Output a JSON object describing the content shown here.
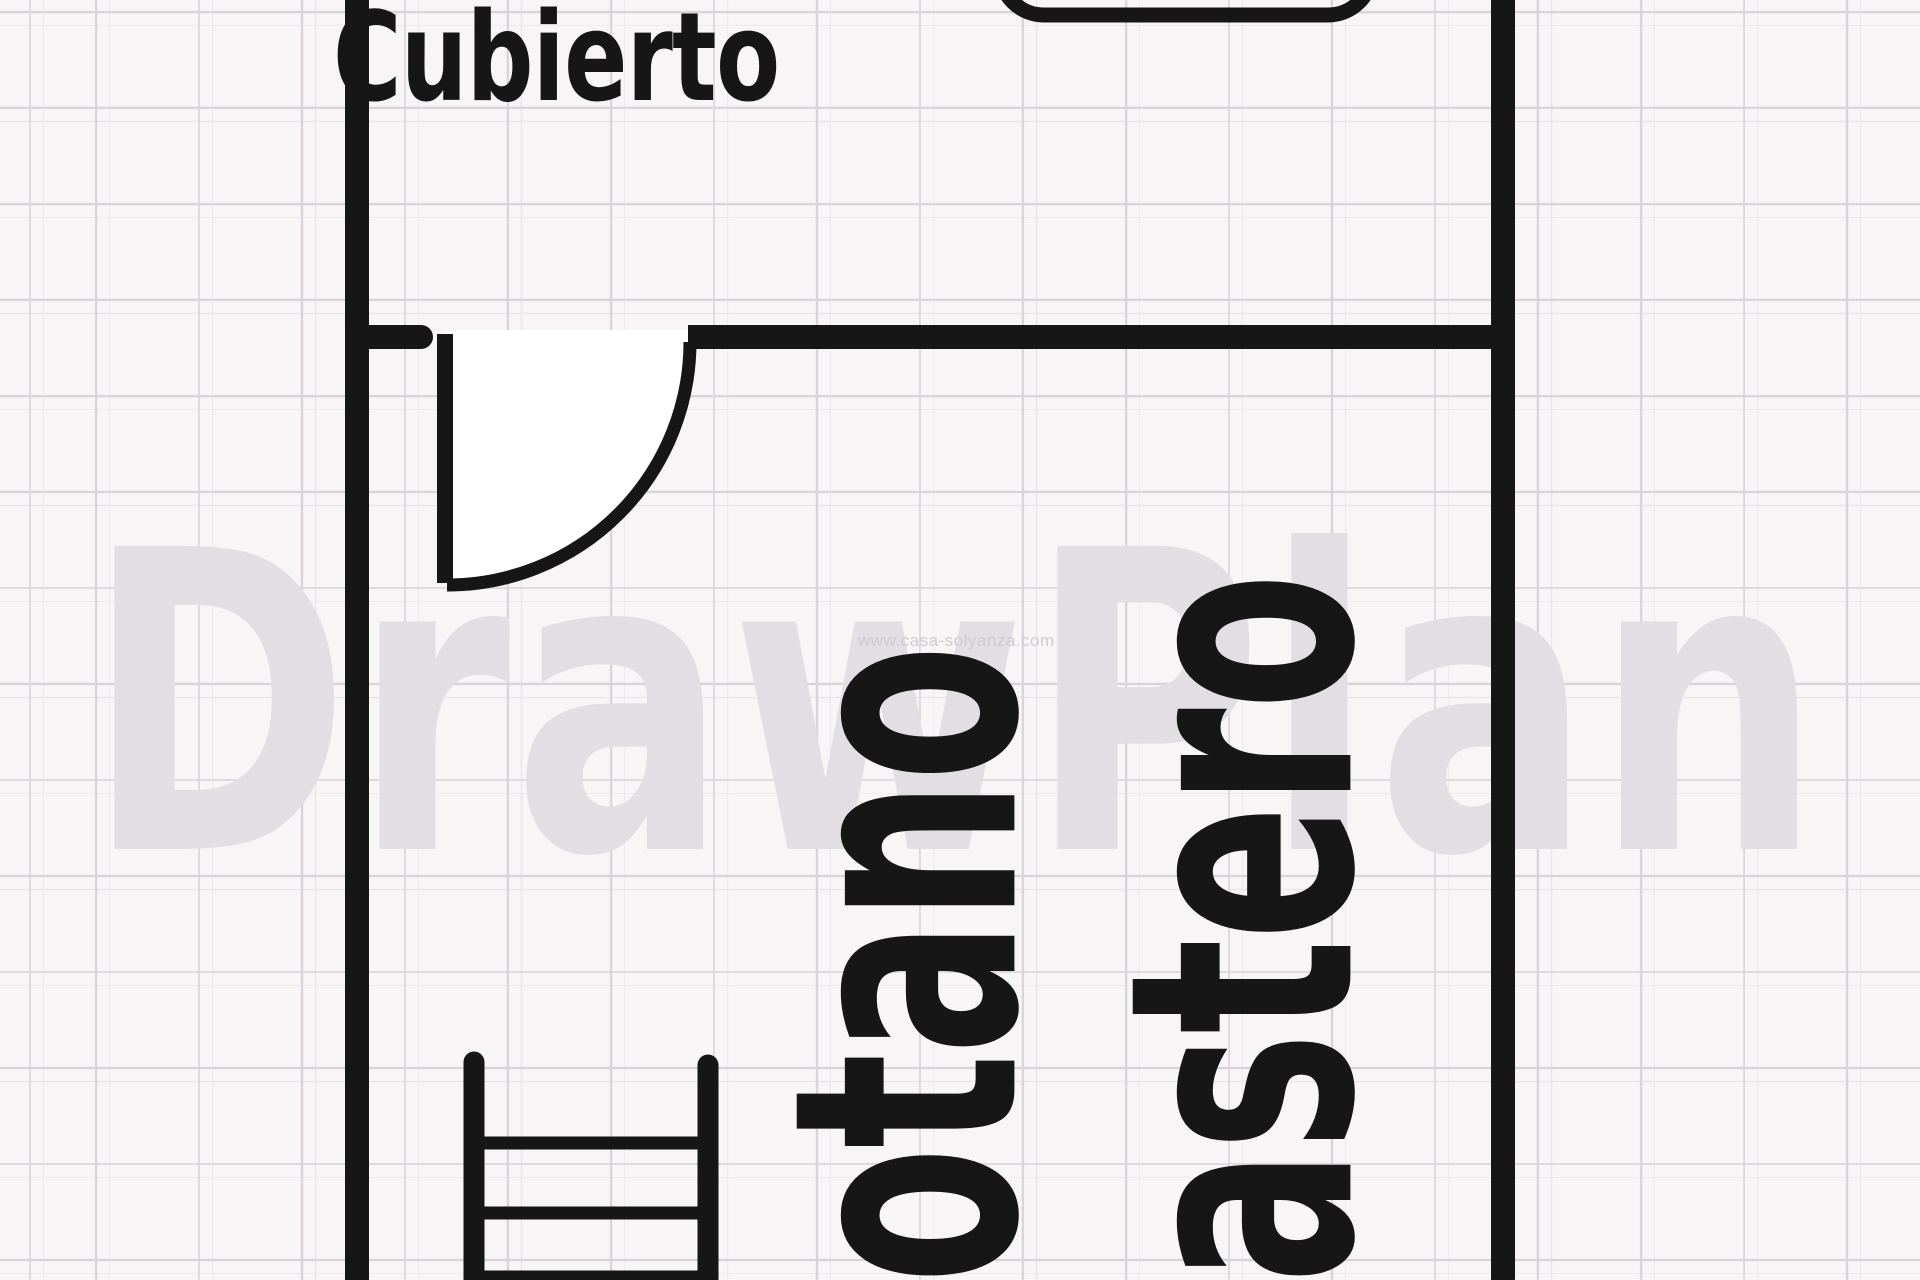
{
  "colors": {
    "background": "#f8f5f7",
    "grid_line": "#d9d2d9",
    "grid_line_faint": "#ebe5eb",
    "ink": "#161616",
    "watermark_text": "#e2dee3",
    "url_text": "#cfcacf",
    "door_swing_fill": "#ffffff"
  },
  "rooms": [
    {
      "label": "Cubierto"
    },
    {
      "label": "otano"
    },
    {
      "label": "astero"
    }
  ],
  "watermark": {
    "text": "DrawPlan",
    "url": "www.casa-solyanza.com"
  },
  "icons": {
    "ladder": "ladder-stairs-symbol",
    "door": "door-leaf-with-swing-arc",
    "fixture": "rounded-rectangle-outline-cut-at-top"
  }
}
